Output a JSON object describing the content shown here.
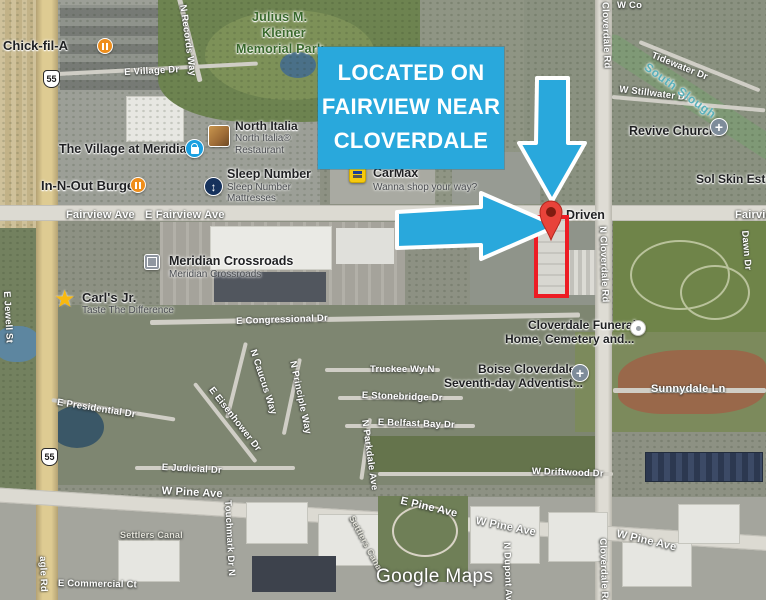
{
  "callout": {
    "line1": "LOCATED ON",
    "line2": "FAIRVIEW NEAR",
    "line3": "CLOVERDALE"
  },
  "watermark": "Google Maps",
  "colors": {
    "annotation_blue": "#29a8dc",
    "annotation_red": "#ed1c24",
    "pin_red": "#e8433a",
    "pin_center": "#801b10",
    "arrow_outline": "#ffffff"
  },
  "shields": [
    {
      "label": "55",
      "x": 43,
      "y": 70
    },
    {
      "label": "55",
      "x": 41,
      "y": 448
    }
  ],
  "labels": [
    {
      "t": "E Village Dr",
      "x": 124,
      "y": 67,
      "r": -3
    },
    {
      "t": "N Records Way",
      "x": 188,
      "y": 4,
      "r": 82
    },
    {
      "t": "Fairview Ave",
      "x": 66,
      "y": 209,
      "cls": "lg"
    },
    {
      "t": "E Fairview Ave",
      "x": 145,
      "y": 209,
      "cls": "lg"
    },
    {
      "t": "Fairview",
      "x": 735,
      "y": 209,
      "cls": "lg"
    },
    {
      "t": "W Co",
      "x": 617,
      "y": 0
    },
    {
      "t": "N Cloverdale Rd",
      "x": 610,
      "y": -8,
      "r": 88
    },
    {
      "t": "N Cloverdale Rd",
      "x": 608,
      "y": 226,
      "r": 88
    },
    {
      "t": "Cloverdale Rd",
      "x": 608,
      "y": 538,
      "r": 88
    },
    {
      "t": "Tidewater Dr",
      "x": 654,
      "y": 50,
      "r": 22
    },
    {
      "t": "W Stillwater Dr",
      "x": 620,
      "y": 84,
      "r": 7
    },
    {
      "t": "South Slough",
      "x": 650,
      "y": 60,
      "r": 36,
      "cls": "water",
      "n": "water-label"
    },
    {
      "t": "Dawn Dr",
      "x": 750,
      "y": 230,
      "r": 85
    },
    {
      "t": "Sunnydale Ln",
      "x": 651,
      "y": 383,
      "cls": "lg"
    },
    {
      "t": "E Congressional Dr",
      "x": 236,
      "y": 316,
      "r": -2
    },
    {
      "t": "E Presidential Dr",
      "x": 58,
      "y": 397,
      "r": 9
    },
    {
      "t": "E Eisenhower Dr",
      "x": 215,
      "y": 385,
      "r": 52
    },
    {
      "t": "N Caucus Way",
      "x": 258,
      "y": 348,
      "r": 72
    },
    {
      "t": "N Principle Way",
      "x": 298,
      "y": 360,
      "r": 78
    },
    {
      "t": "Truckee Wy N",
      "x": 370,
      "y": 364
    },
    {
      "t": "E Stonebridge Dr",
      "x": 362,
      "y": 390,
      "r": 2
    },
    {
      "t": "E Belfast Bay Dr",
      "x": 378,
      "y": 417,
      "r": 2
    },
    {
      "t": "N Parkdale Ave",
      "x": 370,
      "y": 419,
      "r": 82
    },
    {
      "t": "E Judicial Dr",
      "x": 162,
      "y": 462,
      "r": 3
    },
    {
      "t": "W Driftwood Dr",
      "x": 532,
      "y": 466,
      "r": 2
    },
    {
      "t": "W Pine Ave",
      "x": 162,
      "y": 485,
      "r": 3,
      "cls": "lg"
    },
    {
      "t": "E Pine Ave",
      "x": 402,
      "y": 495,
      "r": 13,
      "cls": "lg"
    },
    {
      "t": "W Pine Ave",
      "x": 477,
      "y": 515,
      "r": 11,
      "cls": "lg"
    },
    {
      "t": "W Pine Ave",
      "x": 618,
      "y": 528,
      "r": 13,
      "cls": "lg"
    },
    {
      "t": "Settlers Canal",
      "x": 120,
      "y": 530,
      "cls": "canal",
      "n": "canal-label"
    },
    {
      "t": "Settlers Canal",
      "x": 356,
      "y": 514,
      "r": 62,
      "cls": "canal",
      "n": "canal-label"
    },
    {
      "t": "Touchmark Dr N",
      "x": 233,
      "y": 500,
      "r": 87
    },
    {
      "t": "E Commercial Ct",
      "x": 58,
      "y": 578,
      "r": 1
    },
    {
      "t": "N Dupont Ave",
      "x": 512,
      "y": 542,
      "r": 88
    },
    {
      "t": "agle Rd",
      "x": 48,
      "y": 556,
      "r": 88,
      "n": "eagle-rd-label"
    },
    {
      "t": "E Jewell St",
      "x": 12,
      "y": 291,
      "r": 87
    },
    {
      "t": "Julius M.",
      "x": 252,
      "y": 10,
      "cls": "park",
      "n": "park-label"
    },
    {
      "t": "Kleiner",
      "x": 262,
      "y": 26,
      "cls": "park",
      "n": "park-label"
    },
    {
      "t": "Memorial Park",
      "x": 236,
      "y": 42,
      "cls": "park",
      "n": "park-label"
    }
  ],
  "pois": [
    {
      "n": "chick-fil-a",
      "lines": [
        {
          "t": "Chick-fil-A",
          "x": 3,
          "y": 38,
          "s": 13
        }
      ],
      "icon": {
        "type": "restaurant",
        "glyph": "",
        "x": 97,
        "y": 38,
        "name": "restaurant-icon"
      }
    },
    {
      "n": "the-village-at-meridian",
      "lines": [
        {
          "t": "The Village at Meridian",
          "x": 59,
          "y": 142,
          "s": 12.5
        }
      ],
      "icon": {
        "type": "bag",
        "glyph": "",
        "x": 185,
        "y": 139,
        "name": "shopping-icon"
      }
    },
    {
      "n": "north-italia",
      "lines": [
        {
          "t": "North Italia",
          "x": 235,
          "y": 119
        }
      ],
      "sub": [
        {
          "t": "North Italia®",
          "x": 235,
          "y": 133
        },
        {
          "t": "Restaurant",
          "x": 235,
          "y": 145
        }
      ],
      "icon": {
        "type": "photo",
        "glyph": "",
        "x": 208,
        "y": 125,
        "name": "photo-thumbnail-icon"
      }
    },
    {
      "n": "sleep-number",
      "lines": [
        {
          "t": "Sleep Number",
          "x": 227,
          "y": 167,
          "s": 12.5
        }
      ],
      "sub": [
        {
          "t": "Sleep Number",
          "x": 227,
          "y": 182
        },
        {
          "t": "Mattresses",
          "x": 227,
          "y": 193
        }
      ],
      "icon": {
        "type": "updown",
        "glyph": "↕",
        "x": 204,
        "y": 177,
        "name": "sleep-number-icon"
      }
    },
    {
      "n": "carmax",
      "lines": [
        {
          "t": "CarMax",
          "x": 373,
          "y": 166,
          "s": 12.5
        }
      ],
      "sub": [
        {
          "t": "Wanna shop your way?",
          "x": 373,
          "y": 182
        }
      ],
      "icon": {
        "type": "carmax",
        "glyph": "",
        "x": 349,
        "y": 166,
        "name": "carmax-icon"
      }
    },
    {
      "n": "in-n-out-burger",
      "lines": [
        {
          "t": "In-N-Out Burger",
          "x": 41,
          "y": 178,
          "s": 13
        }
      ],
      "icon": {
        "type": "restaurant",
        "glyph": "",
        "x": 130,
        "y": 177,
        "name": "restaurant-icon"
      }
    },
    {
      "n": "meridian-crossroads",
      "lines": [
        {
          "t": "Meridian Crossroads",
          "x": 169,
          "y": 254,
          "s": 12.5
        }
      ],
      "sub": [
        {
          "t": "Meridian Crossroads",
          "x": 169,
          "y": 269
        }
      ],
      "icon": {
        "type": "building",
        "glyph": "",
        "x": 144,
        "y": 254,
        "name": "shopping-center-icon"
      }
    },
    {
      "n": "carls-jr",
      "lines": [
        {
          "t": "Carl's Jr.",
          "x": 82,
          "y": 290,
          "s": 13
        }
      ],
      "sub": [
        {
          "t": "Taste The Difference",
          "x": 82,
          "y": 305
        }
      ],
      "icon": {
        "type": "star",
        "glyph": "★",
        "x": 54,
        "y": 285,
        "name": "star-icon"
      }
    },
    {
      "n": "revive-church",
      "lines": [
        {
          "t": "Revive Church",
          "x": 629,
          "y": 124,
          "s": 12.5
        }
      ],
      "icon": {
        "type": "church",
        "glyph": "+",
        "x": 710,
        "y": 118,
        "name": "church-icon"
      }
    },
    {
      "n": "sol-skin",
      "lines": [
        {
          "t": "Sol Skin Esthe",
          "x": 696,
          "y": 172
        }
      ]
    },
    {
      "n": "driven",
      "lines": [
        {
          "t": "Driven",
          "x": 566,
          "y": 208,
          "s": 12.5
        }
      ]
    },
    {
      "n": "cloverdale-funeral-home",
      "lines": [
        {
          "t": "Cloverdale Funeral",
          "x": 528,
          "y": 318
        },
        {
          "t": "Home, Cemetery and...",
          "x": 505,
          "y": 332
        }
      ],
      "icon": {
        "type": "dot",
        "glyph": "",
        "x": 630,
        "y": 320,
        "name": "poi-dot-icon"
      }
    },
    {
      "n": "boise-cloverdale-adventist",
      "lines": [
        {
          "t": "Boise Cloverdale",
          "x": 478,
          "y": 362
        },
        {
          "t": "Seventh-day Adventist...",
          "x": 444,
          "y": 376
        }
      ],
      "icon": {
        "type": "church",
        "glyph": "+",
        "x": 571,
        "y": 364,
        "name": "church-icon"
      }
    }
  ]
}
